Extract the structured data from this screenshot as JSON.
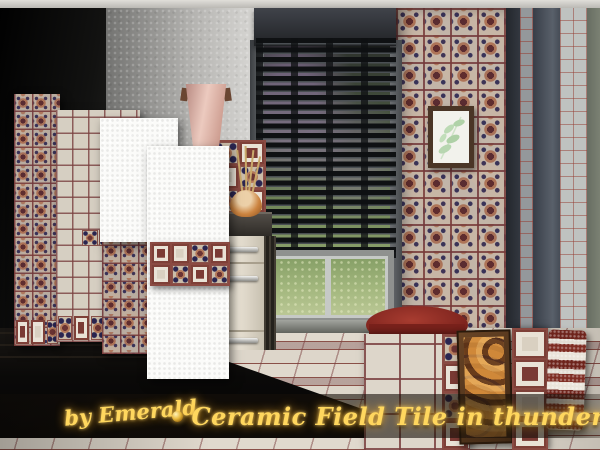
{
  "image_type": "game-screenshot-promo",
  "overlay": {
    "credit": "by Emerald",
    "title": "Ceramic Field Tile in thunder",
    "bullet": "•",
    "text_color": "#ffd75e"
  },
  "palette": {
    "gold": "#ffd75e",
    "grout_maroon": "#7a4040",
    "tile_cream": "#d9d2c6",
    "motif_maroon": "#6b3434",
    "motif_navy": "#2a2550",
    "motif_tan": "#b4795a",
    "wall_dark": "#141414",
    "stucco_white": "#efeeea",
    "blind_dark": "#1b1d1f",
    "foliage_green": "#6f8f5c",
    "lawn_green": "#a4b87f",
    "ottoman_red": "#8d2b24",
    "sconce_pink": "#dcb0a6",
    "frame_wood": "#4a3526"
  },
  "scene": {
    "objects": [
      "ornate-ceramic-tile-wall",
      "plain-ceramic-tile-panels",
      "white-plaster-swatches",
      "venetian-blinds",
      "window-with-garden-view",
      "wall-sconce",
      "botanical-print",
      "kitchen-cabinet",
      "vase-with-branches",
      "red-ottoman",
      "framed-tile-art",
      "bordered-square-tile-panel",
      "striped-rug-roll",
      "patterned-tile-floor"
    ]
  }
}
